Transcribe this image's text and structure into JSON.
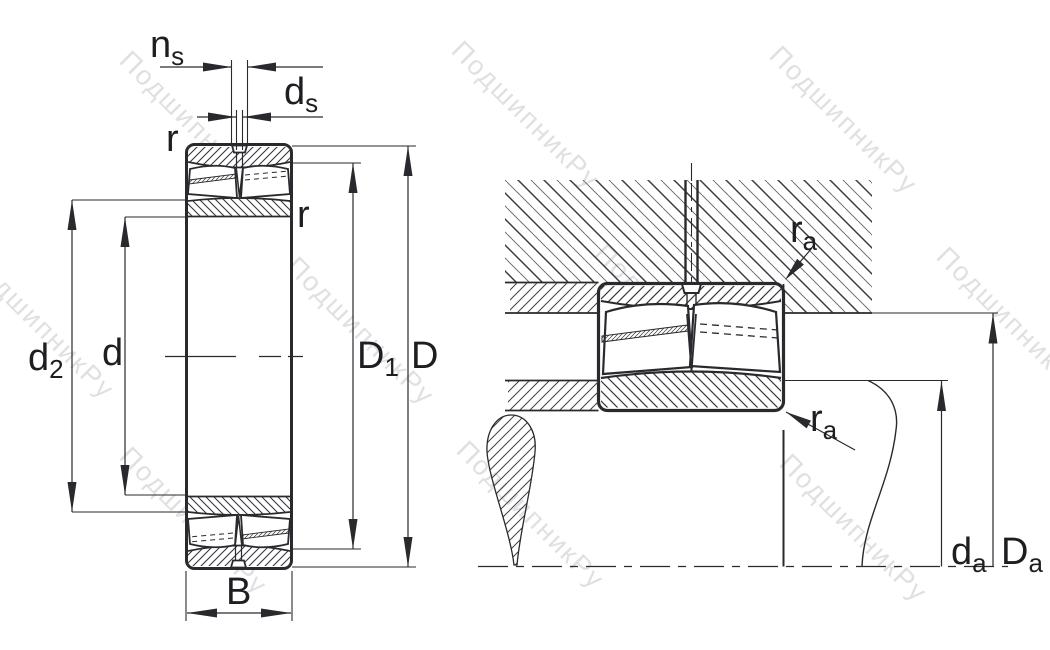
{
  "drawing": {
    "type": "bearing-technical-drawing",
    "watermark": "ПодшипникРу",
    "views": {
      "front_view": "spherical-roller-bearing-cross-section",
      "mounting_view": "bearing-mounted-in-housing-and-shaft-abutment"
    },
    "labels": {
      "ns": {
        "main": "n",
        "sub": "s"
      },
      "ds": {
        "main": "d",
        "sub": "s"
      },
      "r_top": "r",
      "r_side": "r",
      "d2": {
        "main": "d",
        "sub": "2"
      },
      "d": "d",
      "D1": {
        "main": "D",
        "sub": "1"
      },
      "D": "D",
      "B": "B",
      "ra_housing": {
        "main": "r",
        "sub": "a"
      },
      "ra_shaft": {
        "main": "r",
        "sub": "a"
      },
      "da": {
        "main": "d",
        "sub": "a"
      },
      "Da": {
        "main": "D",
        "sub": "a"
      }
    },
    "colors": {
      "line": "#2a2a2e",
      "label": "#1d1d22",
      "hatch": "#38383c",
      "watermark": "#c7c7cd",
      "background": "#ffffff"
    }
  }
}
